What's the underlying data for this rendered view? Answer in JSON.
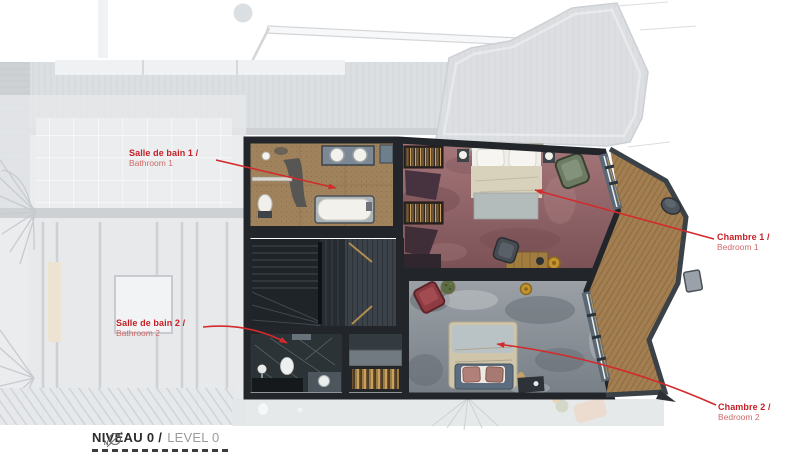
{
  "plan_type": "architectural-floor-plan",
  "annotations": {
    "bathroom1": {
      "title": "Salle de bain 1 /",
      "subtitle": "Bathroom 1"
    },
    "bedroom1": {
      "title": "Chambre 1 /",
      "subtitle": "Bedroom 1"
    },
    "bathroom2": {
      "title": "Salle de bain 2 /",
      "subtitle": "Bathroom 2"
    },
    "bedroom2": {
      "title": "Chambre 2 /",
      "subtitle": "Bedroom 2"
    }
  },
  "title_block": {
    "level_fr": "NIVEAU 0 /",
    "level_en": "LEVEL 0",
    "compass_label": "N"
  },
  "colors": {
    "annotation_red": "#c42127",
    "annotation_red_light": "#d06a6a",
    "arrow_red": "#d42a2c",
    "title_dark": "#2b2b2b",
    "title_grey": "#9b9b9b",
    "walls": "#22262b",
    "bathroom1_floor": "#a0835c",
    "bedroom1_carpet": "#9a696c",
    "bedroom2_carpet": "#8f949a",
    "stair_wood": "#1f2429",
    "bathroom2_marble": "#2b3336",
    "balcony_deck": "#a37e50",
    "window_frame": "#5b6874",
    "faded_structure": "#c6cbd0"
  }
}
